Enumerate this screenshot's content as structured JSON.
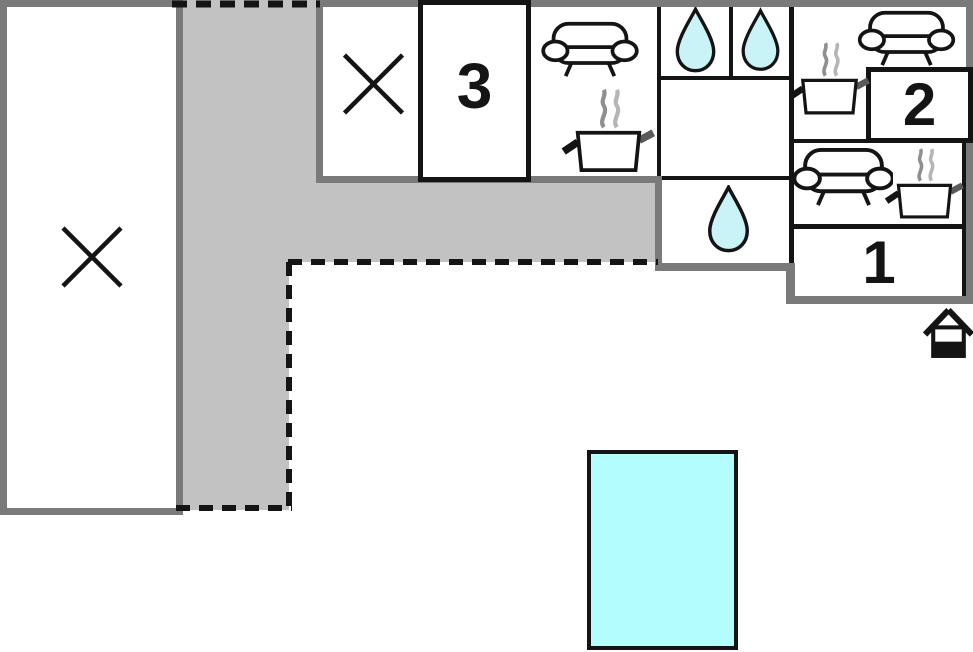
{
  "plan": {
    "type": "apartment-floor-plan",
    "rooms": {
      "bedroom_1": {
        "label": "1"
      },
      "bedroom_2": {
        "label": "2"
      },
      "bedroom_3": {
        "label": "3"
      }
    },
    "features": {
      "left_large_room": "crossed-out-area",
      "top_small_room": "crossed-out-area",
      "hallway": "gray-corridor-l-shaped",
      "kitchen_living_top": [
        "sofa",
        "cooking-pot-with-steam"
      ],
      "bathroom_top_a": "water-drop",
      "bathroom_top_b": "water-drop",
      "bathroom_lower": "water-drop",
      "apartment2_kitchen_living": [
        "cooking-pot-with-steam",
        "sofa"
      ],
      "apartment1_kitchen_living": [
        "sofa",
        "cooking-pot-with-steam"
      ],
      "entrance_marker": "house-icon",
      "pool_area": "swimming-pool"
    },
    "colors": {
      "wall_gray": "#7a7a7a",
      "wall_black": "#141414",
      "corridor_fill": "#c2c2c2",
      "water_drop_fill": "#c9f3f6",
      "pool_fill": "#b3fdff"
    }
  }
}
